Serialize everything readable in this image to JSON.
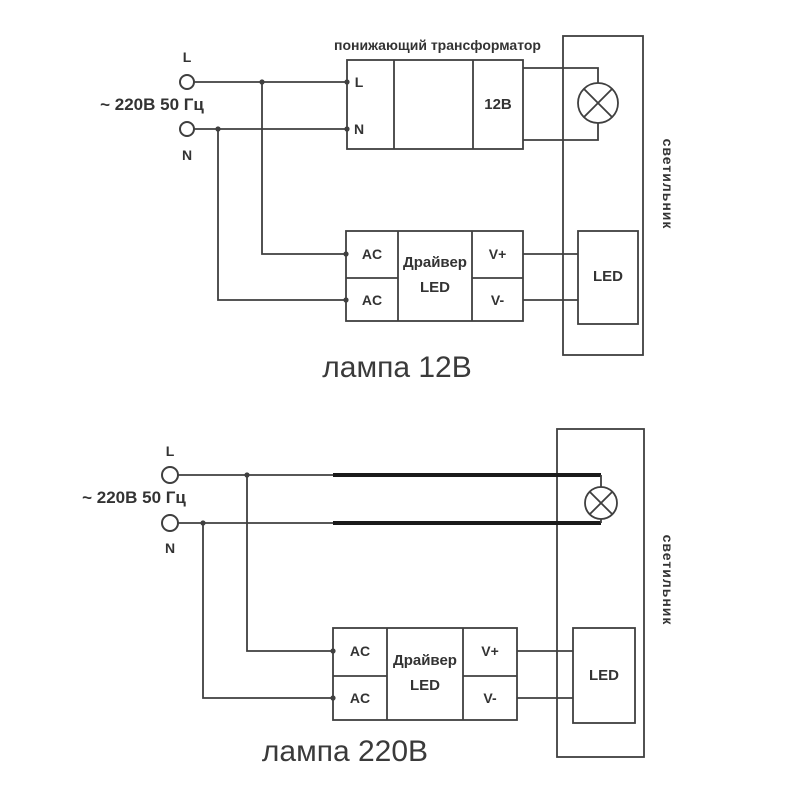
{
  "colors": {
    "line": "#3f3f3f",
    "bold_line": "#1a1a1a",
    "text": "#333333",
    "background": "#ffffff"
  },
  "diagrams": [
    {
      "caption": "лампа 12В",
      "source": {
        "label": "~ 220В 50 Гц",
        "terminal_l": "L",
        "terminal_n": "N"
      },
      "transformer": {
        "title": "понижающий трансформатор",
        "input_l": "L",
        "input_n": "N",
        "output": "12В"
      },
      "driver": {
        "in1": "AC",
        "in2": "AC",
        "name_line1": "Драйвер",
        "name_line2": "LED",
        "out_plus": "V+",
        "out_minus": "V-"
      },
      "led": {
        "label": "LED"
      },
      "luminaire": {
        "label": "светильник"
      }
    },
    {
      "caption": "лампа 220В",
      "source": {
        "label": "~ 220В 50 Гц",
        "terminal_l": "L",
        "terminal_n": "N"
      },
      "driver": {
        "in1": "AC",
        "in2": "AC",
        "name_line1": "Драйвер",
        "name_line2": "LED",
        "out_plus": "V+",
        "out_minus": "V-"
      },
      "led": {
        "label": "LED"
      },
      "luminaire": {
        "label": "светильник"
      }
    }
  ]
}
